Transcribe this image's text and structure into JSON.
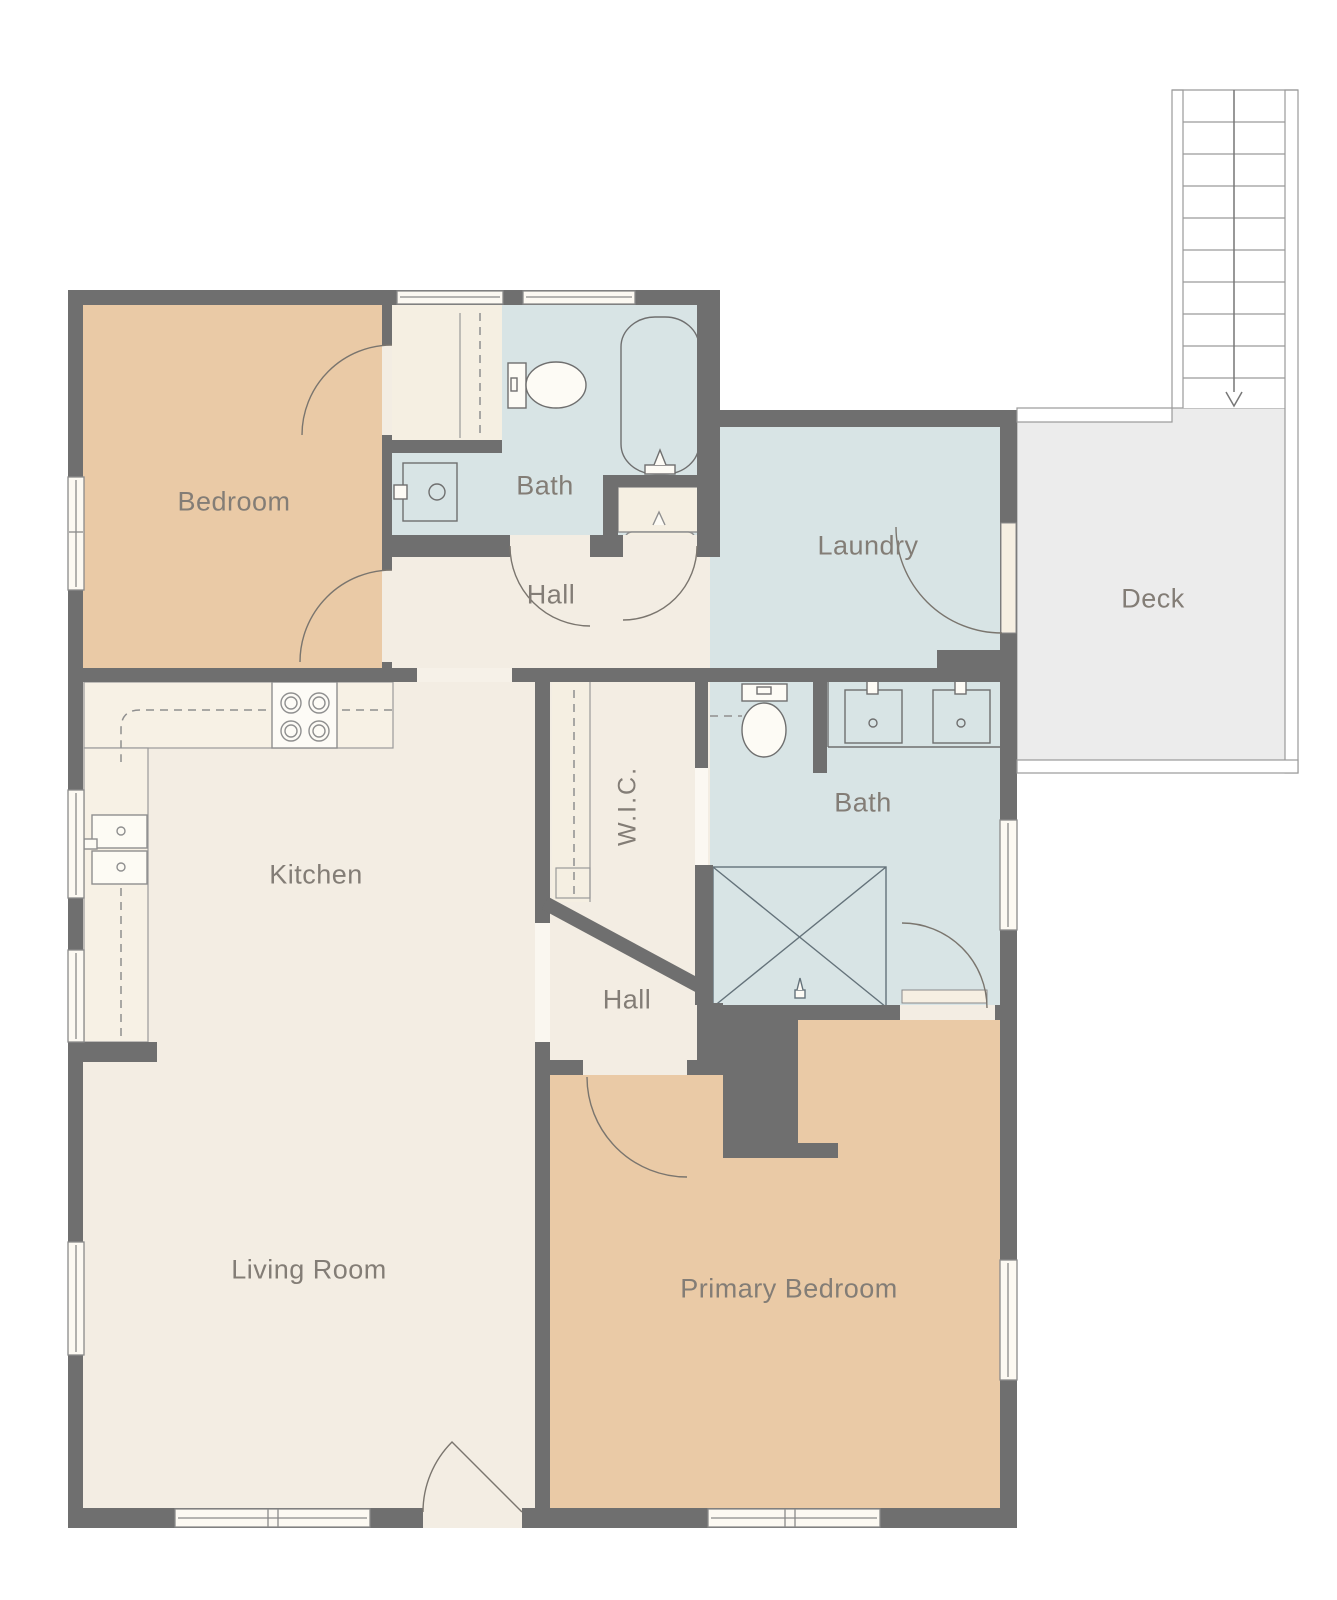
{
  "title": "Single-story floor plan with deck and exterior stairs",
  "rooms": {
    "bedroom": {
      "label": "Bedroom"
    },
    "bath_upper": {
      "label": "Bath"
    },
    "hall_upper": {
      "label": "Hall"
    },
    "laundry": {
      "label": "Laundry"
    },
    "deck": {
      "label": "Deck"
    },
    "kitchen": {
      "label": "Kitchen"
    },
    "wic": {
      "label": "W.I.C."
    },
    "bath_lower": {
      "label": "Bath"
    },
    "hall_lower": {
      "label": "Hall"
    },
    "living_room": {
      "label": "Living Room"
    },
    "primary_bedroom": {
      "label": "Primary Bedroom"
    }
  },
  "stairs": {
    "treads": 10,
    "direction": "down-arrow"
  },
  "fixtures": [
    "toilet",
    "bathtub",
    "vanity-sink",
    "washer",
    "double-vanity-sinks",
    "shower",
    "stove",
    "kitchen-double-sink",
    "closet-rod-dashed"
  ],
  "colors": {
    "wall": "#6f6f6f",
    "bedroom_fill": "#eacaa6",
    "wet_room_fill": "#d8e4e5",
    "floor_cream": "#f3ede3",
    "counter_cream": "#f7f1e5",
    "deck_fill": "#ececec",
    "label_text": "#837d76",
    "fixture_line": "#6f6f6f",
    "thin_line": "#8f8f8f"
  }
}
